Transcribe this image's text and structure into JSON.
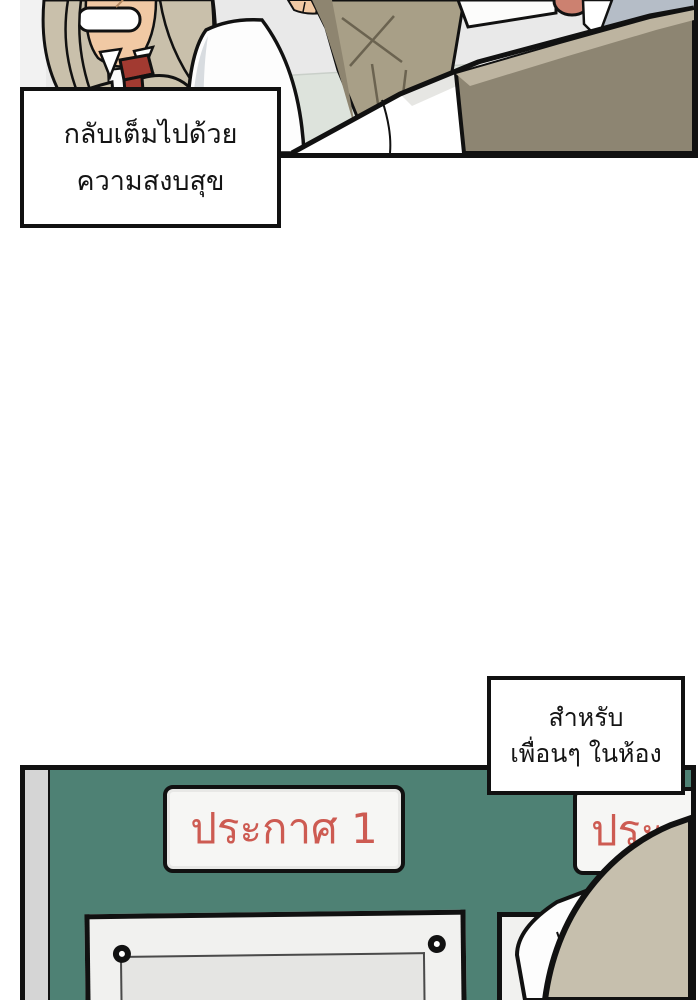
{
  "page": {
    "type": "webtoon-comic-page",
    "panel_count": 2
  },
  "narration_boxes": [
    {
      "id": "narration-1",
      "lines": [
        "กลับเต็มไปด้วย",
        "ความสงบสุข"
      ]
    },
    {
      "id": "narration-2",
      "lines": [
        "สำหรับ",
        "เพื่อนๆ ในห้อง"
      ]
    }
  ],
  "signs": {
    "sign1_label": "ประกาศ 1",
    "sign2_label": "ประ"
  },
  "colors": {
    "page_bg": "#ffffff",
    "ink": "#111111",
    "panel_bg": "#e9e9e9",
    "margin_gray": "#f2f2f2",
    "table_green": "#dde3dc",
    "hair_tan": "#c9c0ab",
    "skin": "#f1c9a4",
    "tie_red": "#a23a31",
    "vest_tan": "#cdc4ae",
    "shirt_white": "#fdfdfd",
    "shirt_shadow": "#d8dce0",
    "pants_khaki": "#a89f87",
    "pants_shadow": "#8e8570",
    "wrinkle": "#6b6350",
    "jacket_khaki": "#8d8572",
    "jacket_highlight": "#bdb4a0",
    "wall_bluegray": "#b5bdc7",
    "salmon": "#cc8170",
    "board_green": "#4e8174",
    "strip_gray": "#d5d5d5",
    "sign_white": "#f6f6f4",
    "sign_red": "#cd5b52",
    "notice_white": "#f1f1ef",
    "paper_gray": "#e5e5e3",
    "hair_tan_light": "#c6bfad",
    "fg_shirt_shadow": "#e6e6e3",
    "box_white": "#ffffff"
  }
}
